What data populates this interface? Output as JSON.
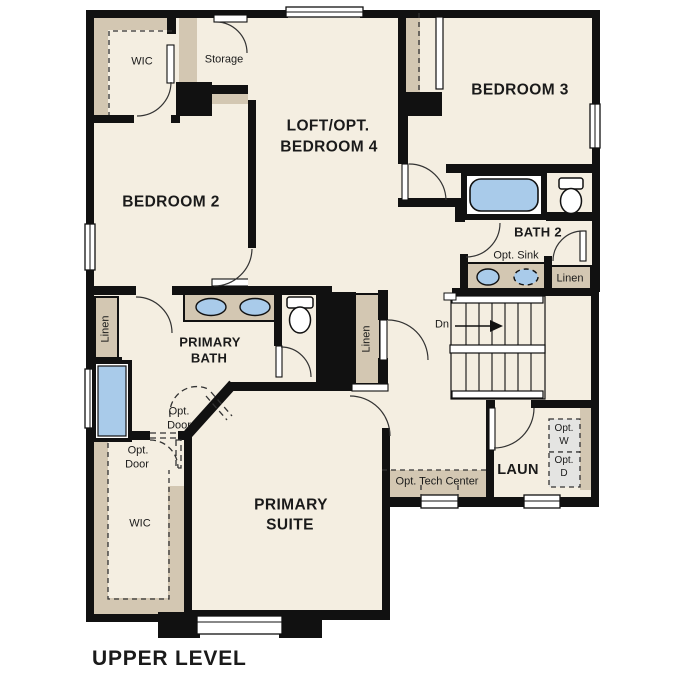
{
  "title": "UPPER LEVEL",
  "colors": {
    "floor": "#f4eee1",
    "cabinet": "#d3c7b2",
    "wall": "#111111",
    "fixture": "#a9cbea",
    "appliance": "#e4e4e2",
    "text": "#1a1a1a"
  },
  "rooms": {
    "wic_upper": "WIC",
    "storage": "Storage",
    "bedroom2": "BEDROOM 2",
    "loft_line1": "LOFT/OPT.",
    "loft_line2": "BEDROOM 4",
    "bedroom3": "BEDROOM 3",
    "bath2": "BATH 2",
    "primary_bath_line1": "PRIMARY",
    "primary_bath_line2": "BATH",
    "primary_suite_line1": "PRIMARY",
    "primary_suite_line2": "SUITE",
    "laundry": "LAUN",
    "wic_lower": "WIC"
  },
  "annotations": {
    "opt_sink": "Opt. Sink",
    "linen_bath2": "Linen",
    "linen_hall": "Linen",
    "linen_primary": "Linen",
    "stairs_direction": "Dn",
    "opt_door_line1": "Opt.",
    "opt_door_line2": "Door",
    "opt_washer_line1": "Opt.",
    "opt_washer_line2": "W",
    "opt_dryer_line1": "Opt.",
    "opt_dryer_line2": "D",
    "tech_center": "Opt. Tech Center"
  }
}
